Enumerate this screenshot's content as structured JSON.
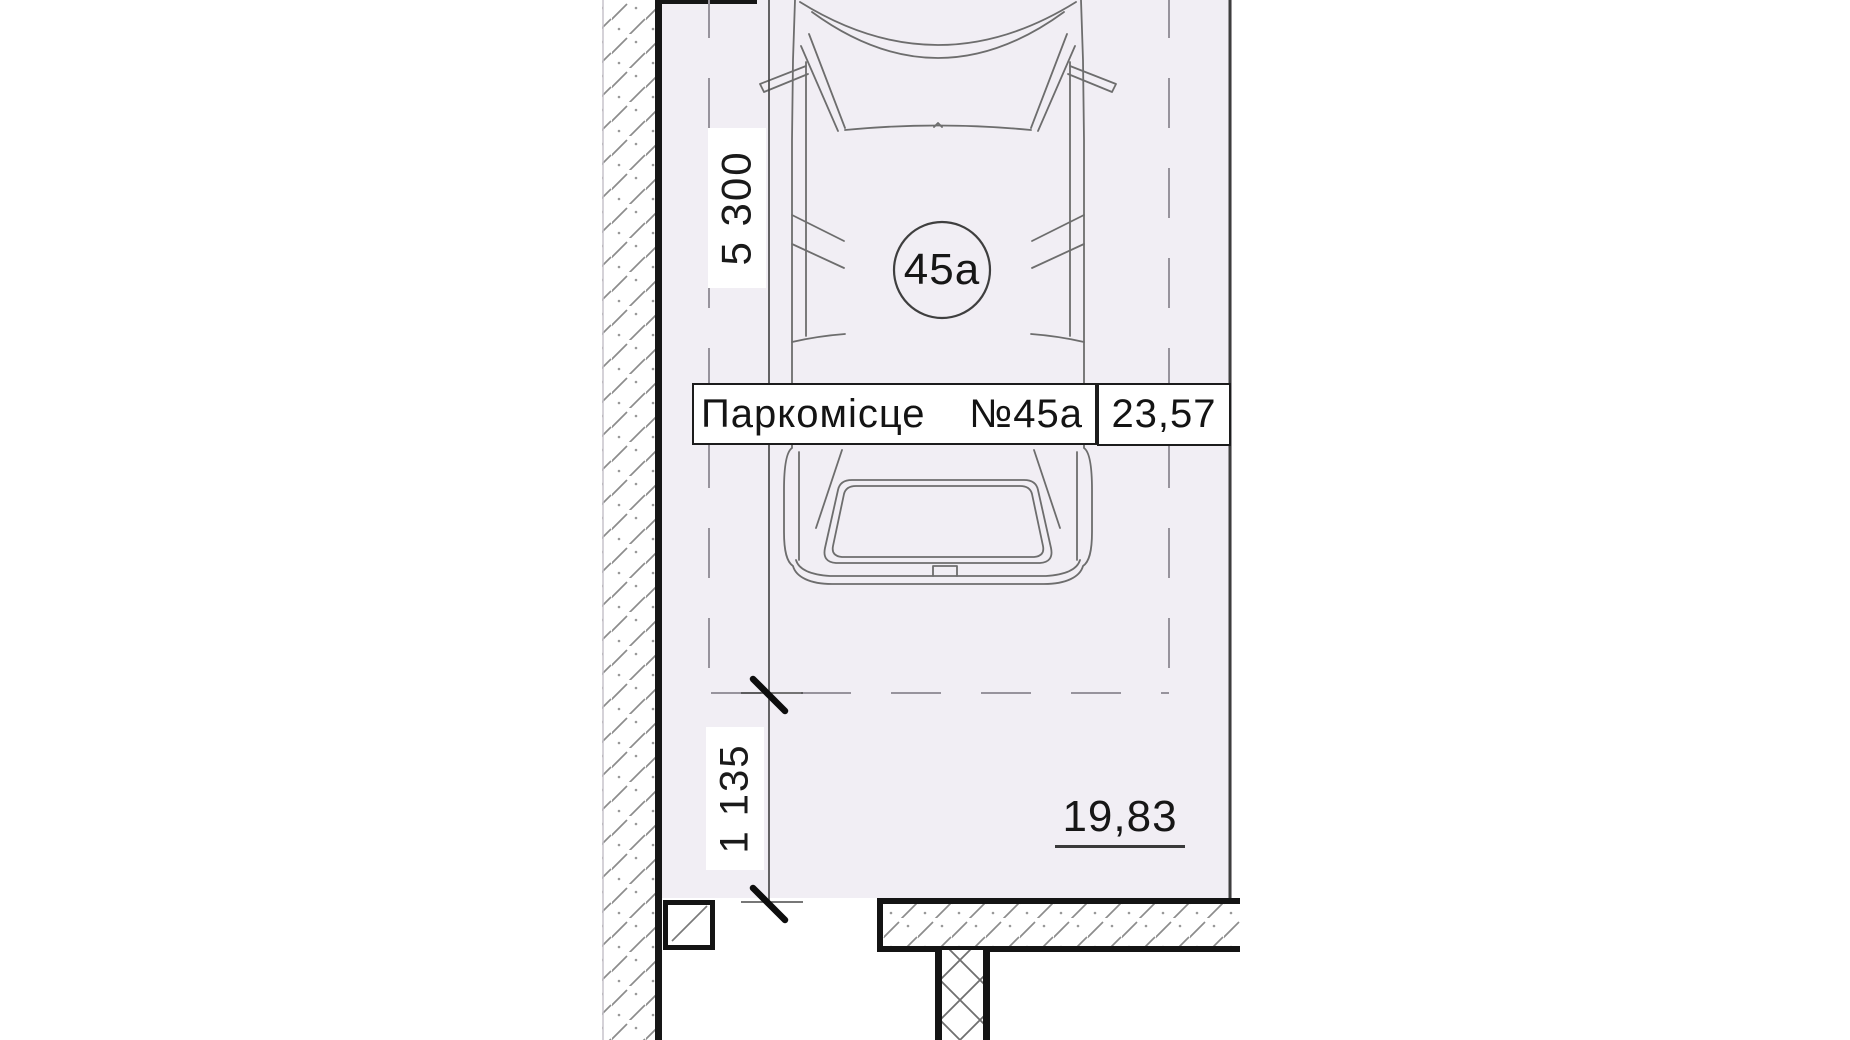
{
  "drawing": {
    "title_hint": "parking space floor plan",
    "background_color": "#f1eef4",
    "dimensions": {
      "length": "5 300",
      "offset": "1 135"
    },
    "badge_number": "45а",
    "parking_label": {
      "name": "Паркомісце",
      "number": "№45а",
      "area": "23,57"
    },
    "area_note": "19,83",
    "colors": {
      "interior": "#f1eef4",
      "paper": "#ffffff",
      "wall_line": "#161616",
      "car_line": "#6d6d6d",
      "dashed_boundary": "#97939c",
      "dimension_line": "#4a4a4a"
    }
  }
}
